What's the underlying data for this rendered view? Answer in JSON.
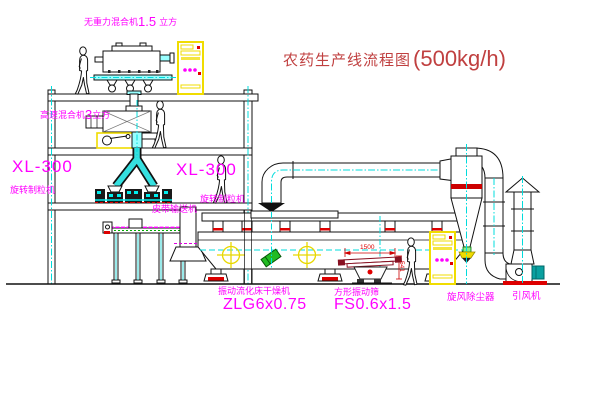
{
  "title": {
    "name": "农药生产线流程图",
    "capacity": "(500kg/h)"
  },
  "labels": {
    "mixer_top": {
      "prefix": "无重力混合机",
      "value": "1.5",
      "unit": "立方"
    },
    "mixer_l2": {
      "prefix": "高速混合机",
      "value": "3",
      "unit": "立方"
    },
    "granulator_left": {
      "model": "XL-300",
      "name": "旋转制粒机"
    },
    "granulator_right": {
      "model": "XL-300",
      "name": "旋转制粒机"
    },
    "belt_conveyor": "皮带输送机",
    "dryer": {
      "name": "振动流化床干燥机",
      "model": "ZLG6x0.75"
    },
    "sieve": {
      "name": "方形振动筛",
      "model": "FS0.6x1.5"
    },
    "cyclone": "旋风除尘器",
    "fan": "引风机"
  },
  "dimensions": {
    "sieve_length": "1500",
    "sieve_height": "541"
  },
  "colors": {
    "label_magenta": "#ff00ff",
    "title_red": "#c04040",
    "centerline_cyan": "#00dcdc",
    "cabinet_yellow": "#f0dc00",
    "status_red": "#dd0000",
    "conveyor_green": "#00aa00"
  }
}
